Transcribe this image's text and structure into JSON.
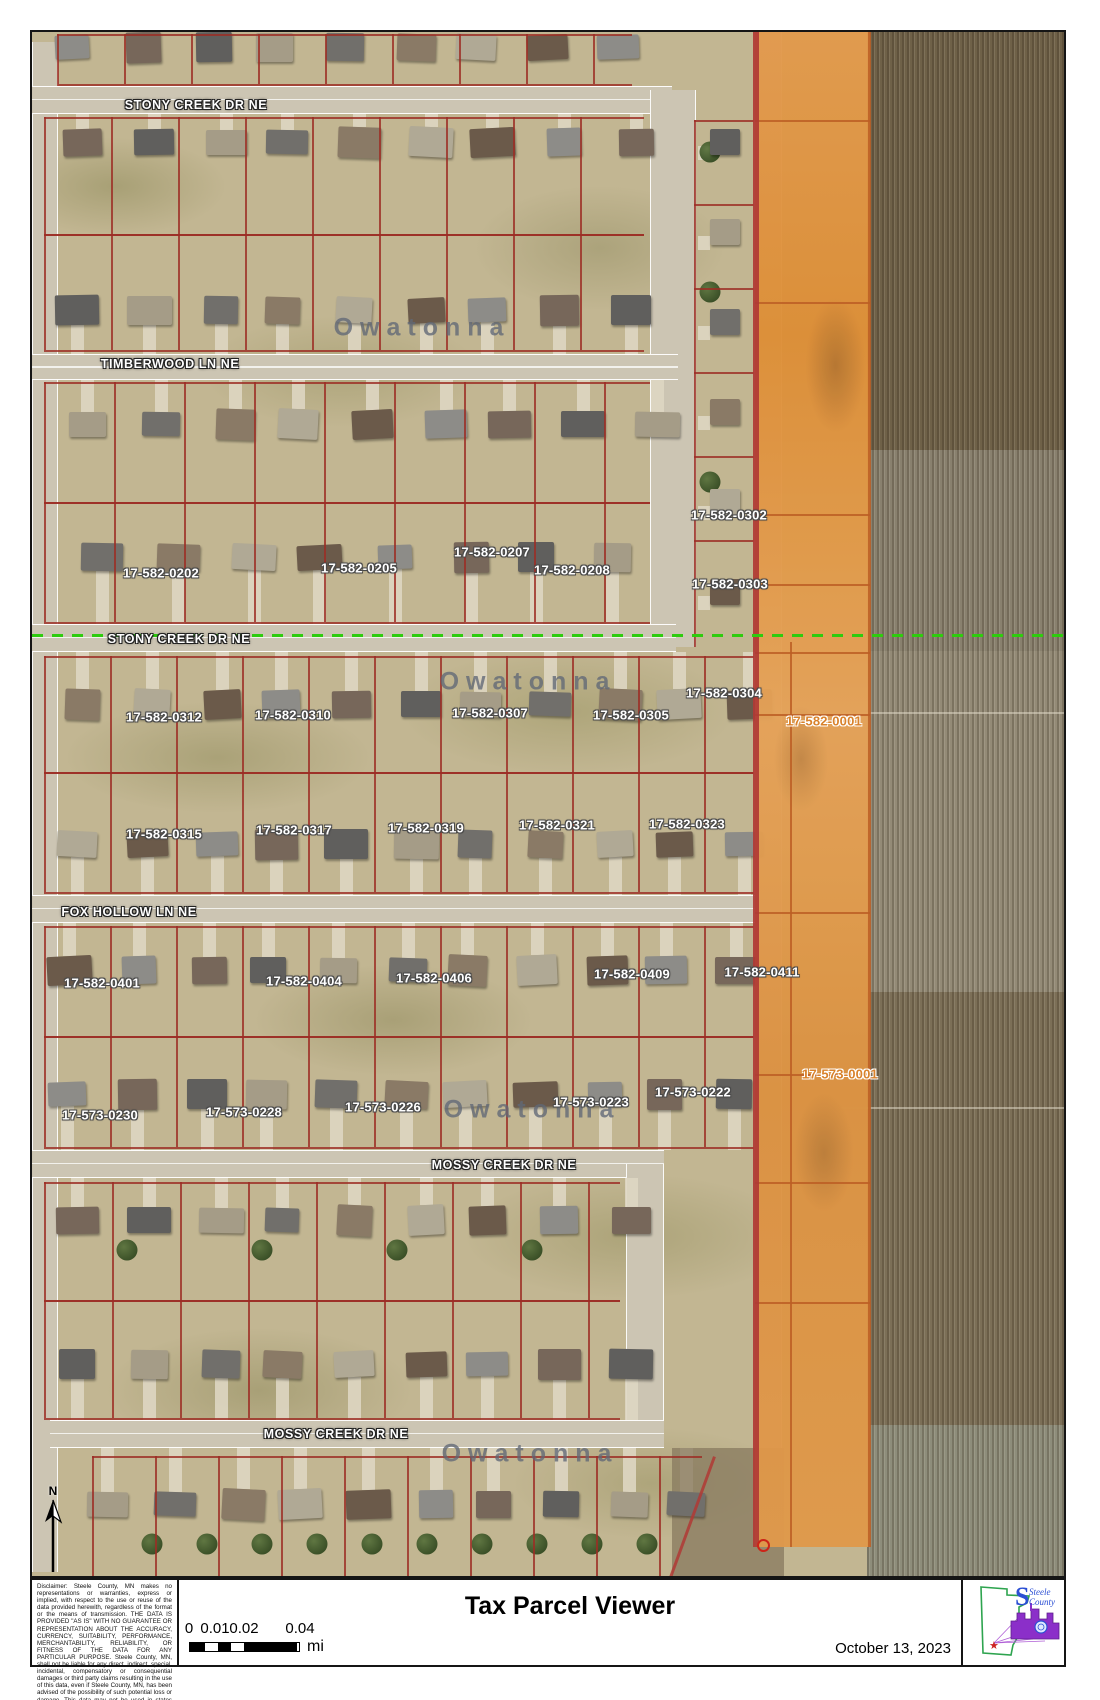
{
  "title": "Tax Parcel Viewer",
  "date": "October 13, 2023",
  "north_label": "N",
  "scale_bar": {
    "labels": [
      "0",
      "0.01",
      "0.02",
      "0.04"
    ],
    "unit": "mi"
  },
  "disclaimer": "Disclaimer:  Steele County, MN makes no representations or warranties, express or implied, with respect to the use or reuse of the data provided herewith, regardless of the format or the means of transmission. THE DATA IS PROVIDED \"AS IS\" WITH NO GUARANTEE OR REPRESENTATION ABOUT THE ACCURACY, CURRENCY, SUITABILITY, PERFORMANCE, MERCHANTABILITY, RELIABILITY, OR FITNESS OF THE DATA FOR ANY PARTICULAR PURPOSE. Steele County, MN, shall not be liable for any direct, indirect, special, incidental, compensatory or consequential damages or third party claims resulting in the use of this data, even if Steele County, MN, has been advised of the possibility of such potential loss or damage. This data may not be used in states that do not allow the exclusion or limitation of incidental or consequential damages.",
  "logo": {
    "line1": "Steele",
    "line2": "County"
  },
  "colors": {
    "parcel_line": "#9c2d24",
    "highlight_parcel": "#dd8e36",
    "orange_label": "#d9822b",
    "section_line_green": "#2ecc0e"
  },
  "watermark": {
    "text": "Owatonna",
    "positions": [
      {
        "x": 420,
        "y": 326
      },
      {
        "x": 526,
        "y": 680
      },
      {
        "x": 530,
        "y": 1108
      },
      {
        "x": 528,
        "y": 1452
      }
    ]
  },
  "streets": [
    {
      "name": "STONY CREEK DR NE",
      "x": 194,
      "y": 103
    },
    {
      "name": "TIMBERWOOD LN NE",
      "x": 168,
      "y": 362
    },
    {
      "name": "STONY CREEK DR NE",
      "x": 177,
      "y": 637
    },
    {
      "name": "FOX HOLLOW LN NE",
      "x": 127,
      "y": 910
    },
    {
      "name": "MOSSY CREEK DR NE",
      "x": 502,
      "y": 1163
    },
    {
      "name": "MOSSY CREEK DR NE",
      "x": 334,
      "y": 1432
    }
  ],
  "parcels": [
    {
      "id": "17-582-0202",
      "x": 159,
      "y": 571
    },
    {
      "id": "17-582-0205",
      "x": 357,
      "y": 566
    },
    {
      "id": "17-582-0207",
      "x": 490,
      "y": 550
    },
    {
      "id": "17-582-0208",
      "x": 570,
      "y": 568
    },
    {
      "id": "17-582-0302",
      "x": 727,
      "y": 513
    },
    {
      "id": "17-582-0303",
      "x": 728,
      "y": 582
    },
    {
      "id": "17-582-0304",
      "x": 722,
      "y": 691
    },
    {
      "id": "17-582-0312",
      "x": 162,
      "y": 715
    },
    {
      "id": "17-582-0310",
      "x": 291,
      "y": 713
    },
    {
      "id": "17-582-0307",
      "x": 488,
      "y": 711
    },
    {
      "id": "17-582-0305",
      "x": 629,
      "y": 713
    },
    {
      "id": "17-582-0001",
      "x": 822,
      "y": 719,
      "highlight": true
    },
    {
      "id": "17-582-0315",
      "x": 162,
      "y": 832
    },
    {
      "id": "17-582-0317",
      "x": 292,
      "y": 828
    },
    {
      "id": "17-582-0319",
      "x": 424,
      "y": 826
    },
    {
      "id": "17-582-0321",
      "x": 555,
      "y": 823
    },
    {
      "id": "17-582-0323",
      "x": 685,
      "y": 822
    },
    {
      "id": "17-582-0401",
      "x": 100,
      "y": 981
    },
    {
      "id": "17-582-0404",
      "x": 302,
      "y": 979
    },
    {
      "id": "17-582-0406",
      "x": 432,
      "y": 976
    },
    {
      "id": "17-582-0409",
      "x": 630,
      "y": 972
    },
    {
      "id": "17-582-0411",
      "x": 760,
      "y": 970
    },
    {
      "id": "17-573-0001",
      "x": 838,
      "y": 1072,
      "highlight": true
    },
    {
      "id": "17-573-0230",
      "x": 98,
      "y": 1113
    },
    {
      "id": "17-573-0228",
      "x": 242,
      "y": 1110
    },
    {
      "id": "17-573-0226",
      "x": 381,
      "y": 1105
    },
    {
      "id": "17-573-0223",
      "x": 589,
      "y": 1100
    },
    {
      "id": "17-573-0222",
      "x": 691,
      "y": 1090
    }
  ]
}
